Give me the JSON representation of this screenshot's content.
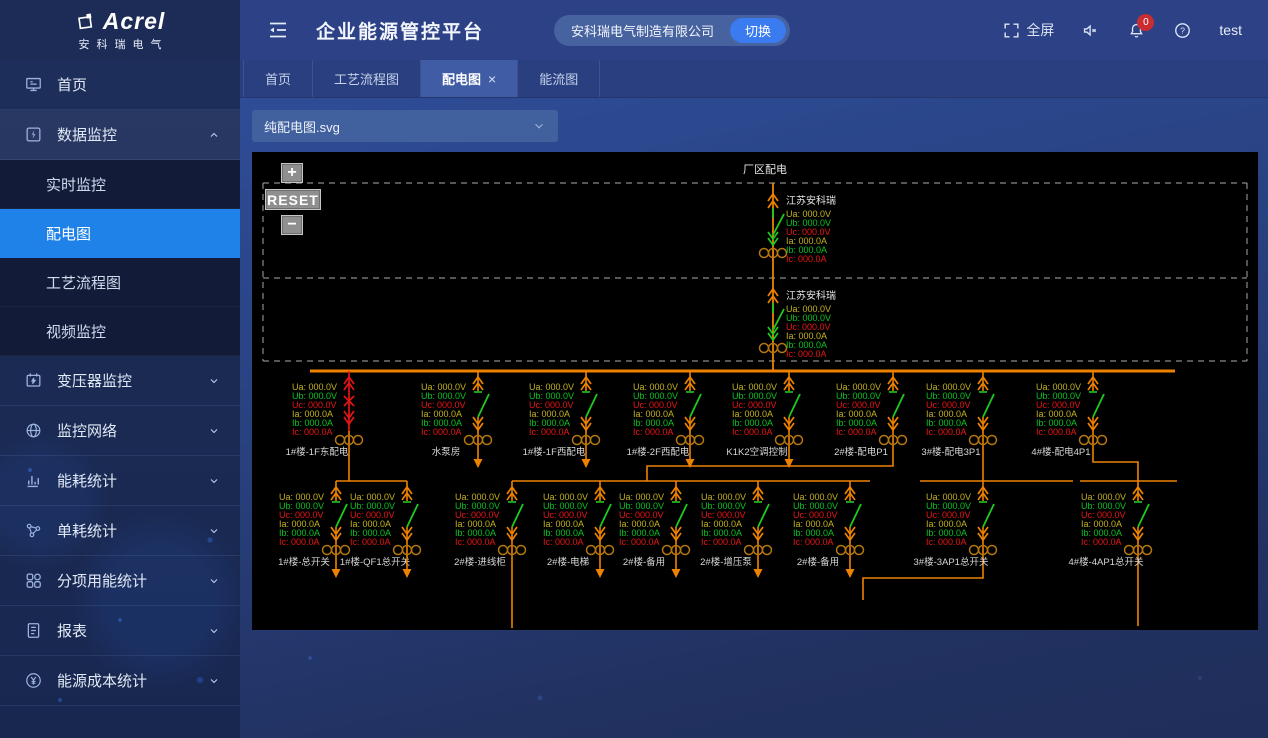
{
  "logo": {
    "brand": "Acrel",
    "sub": "安科瑞电气"
  },
  "header": {
    "title": "企业能源管控平台",
    "company": "安科瑞电气制造有限公司",
    "switch_label": "切换",
    "fullscreen_label": "全屏",
    "notification_count": "0",
    "username": "test"
  },
  "sidebar": {
    "items": [
      {
        "key": "home",
        "icon": "home-icon",
        "label": "首页"
      },
      {
        "key": "data-monitoring",
        "icon": "data-monitor-icon",
        "label": "数据监控",
        "expanded": true,
        "children": [
          {
            "key": "realtime-monitoring",
            "label": "实时监控"
          },
          {
            "key": "distribution-diagram",
            "label": "配电图",
            "active": true
          },
          {
            "key": "process-flow-diagram",
            "label": "工艺流程图"
          },
          {
            "key": "video-monitoring",
            "label": "视频监控"
          }
        ]
      },
      {
        "key": "transformer-monitoring",
        "icon": "transformer-icon",
        "label": "变压器监控",
        "collapsible": true
      },
      {
        "key": "monitoring-network",
        "icon": "network-icon",
        "label": "监控网络",
        "collapsible": true
      },
      {
        "key": "energy-consumption-stats",
        "icon": "bar-chart-icon",
        "label": "能耗统计",
        "collapsible": true
      },
      {
        "key": "unit-consumption-stats",
        "icon": "share-nodes-icon",
        "label": "单耗统计",
        "collapsible": true
      },
      {
        "key": "subitem-energy-stats",
        "icon": "grid-icon",
        "label": "分项用能统计",
        "collapsible": true
      },
      {
        "key": "reports",
        "icon": "report-icon",
        "label": "报表",
        "collapsible": true
      },
      {
        "key": "energy-cost-stats",
        "icon": "cost-icon",
        "label": "能源成本统计",
        "collapsible": true
      }
    ]
  },
  "tabs": [
    {
      "key": "home",
      "label": "首页"
    },
    {
      "key": "process-flow",
      "label": "工艺流程图"
    },
    {
      "key": "distribution",
      "label": "配电图",
      "active": true,
      "closable": true
    },
    {
      "key": "energy-flow",
      "label": "能流图"
    }
  ],
  "file_selector": {
    "value": "纯配电图.svg"
  },
  "diagram": {
    "title": "厂区配电",
    "controls": {
      "zoom_in": "+",
      "reset": "RESET",
      "zoom_out": "−"
    },
    "colors": {
      "line": "#ee8200",
      "switch_closed": "#1ecb1e",
      "alarm": "#e81414",
      "ct": "#b5760f",
      "label": "#d6d6d6",
      "dash": "#8a8a8a",
      "phase_a": "#c4b320",
      "phase_b": "#0ac422",
      "phase_c": "#ea1515"
    },
    "measurements": [
      {
        "text": "Ua: 000.0V",
        "phase": "a"
      },
      {
        "text": "Ub: 000.0V",
        "phase": "b"
      },
      {
        "text": "Uc: 000.0V",
        "phase": "c"
      },
      {
        "text": "Ia: 000.0A",
        "phase": "a"
      },
      {
        "text": "Ib: 000.0A",
        "phase": "b"
      },
      {
        "text": "Ic: 000.0A",
        "phase": "c"
      }
    ],
    "incomers": [
      {
        "name": "江苏安科瑞",
        "x": 521,
        "y": 36
      },
      {
        "name": "江苏安科瑞",
        "x": 521,
        "y": 131
      }
    ],
    "bus": [
      58,
      219,
      923,
      219
    ],
    "riser": [
      521,
      31,
      521,
      219
    ],
    "dashed_lines": [
      [
        11,
        31,
        995,
        31
      ],
      [
        11,
        126,
        995,
        126
      ],
      [
        11,
        209,
        995,
        209
      ],
      [
        11,
        31,
        11,
        209
      ],
      [
        995,
        31,
        995,
        209
      ]
    ],
    "rows": [
      {
        "bus_y": 219,
        "branches": [
          {
            "x": 97,
            "label": "1#楼-1F东配电",
            "state": "red"
          },
          {
            "x": 226,
            "label": "水泵房",
            "end": "arrow"
          },
          {
            "x": 334,
            "label": "1#楼-1F西配电",
            "end": "arrow"
          },
          {
            "x": 438,
            "label": "1#楼-2F西配电",
            "end": "arrow"
          },
          {
            "x": 537,
            "label": "K1K2空调控制",
            "end": "arrow"
          },
          {
            "x": 641,
            "label": "2#楼-配电P1"
          },
          {
            "x": 731,
            "label": "3#楼-配电3P1"
          },
          {
            "x": 841,
            "label": "4#楼-配电4P1"
          }
        ]
      },
      {
        "bus_y": 329,
        "branches": [
          {
            "x": 84,
            "label": "1#楼-总开关",
            "end": "arrow"
          },
          {
            "x": 155,
            "label": "1#楼-QF1总开关",
            "end": "arrow"
          },
          {
            "x": 260,
            "label": "2#楼-进线柜"
          },
          {
            "x": 348,
            "label": "2#楼-电梯",
            "end": "arrow"
          },
          {
            "x": 424,
            "label": "2#楼-备用",
            "end": "arrow"
          },
          {
            "x": 506,
            "label": "2#楼-增压泵",
            "end": "arrow"
          },
          {
            "x": 598,
            "label": "2#楼-备用",
            "end": "arrow"
          },
          {
            "x": 731,
            "label": "3#楼-3AP1总开关"
          },
          {
            "x": 886,
            "label": "4#楼-4AP1总开关"
          }
        ]
      }
    ],
    "connectors": [
      [
        97,
        293,
        97,
        329
      ],
      [
        84,
        329,
        155,
        329
      ],
      [
        641,
        293,
        641,
        314,
        395,
        314,
        395,
        329
      ],
      [
        260,
        329,
        618,
        329
      ],
      [
        731,
        293,
        731,
        329
      ],
      [
        668,
        329,
        821,
        329
      ],
      [
        841,
        293,
        841,
        310,
        886,
        310,
        886,
        329
      ],
      [
        828,
        329,
        925,
        329
      ],
      [
        260,
        403,
        260,
        476
      ],
      [
        731,
        403,
        731,
        426,
        611,
        426,
        611,
        448
      ],
      [
        886,
        403,
        886,
        474
      ]
    ]
  }
}
